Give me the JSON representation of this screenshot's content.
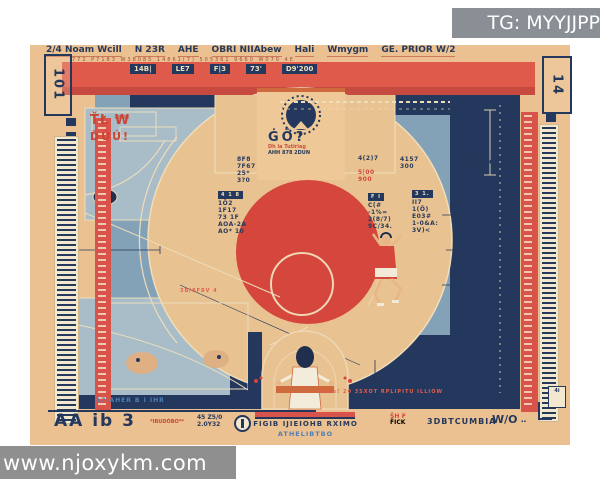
{
  "watermarks": {
    "tg": "TG: MYYJJPP",
    "site": "www.njoxykm.com"
  },
  "colors": {
    "poster_tan": "#ecc191",
    "banner_red": "#e05a4c",
    "navy": "#24375c",
    "court_blue": "#84a2b7",
    "panel_blue": "#a8bdc8",
    "circle_red": "#d5463c",
    "cream": "#f0ddba",
    "accent_orange": "#cf6a3d"
  },
  "header": {
    "tokens": [
      "2/4 Noam Wcill",
      "N 23R",
      "AHE",
      "OBRI NIIAbew",
      "Hali",
      "Wmygm",
      "GE. PRIOR W/2"
    ],
    "sub": "772 P7183 W38085  14861(7)  505361  9660  W070  4E"
  },
  "corners": {
    "left": "101",
    "right": "14",
    "bottom_right_chip": "4i"
  },
  "banner": {
    "chips": [
      "14B|",
      "LE7",
      "F|3",
      "73'",
      "D9'200"
    ]
  },
  "center_top": {
    "caption": "ĠŌ?",
    "sub1": "Dh ia Tutiriag",
    "sub2": "AHH 878 2DUN"
  },
  "stacks": {
    "a": {
      "lines": "8F8\n7F67\n25*\n3?0"
    },
    "b": {
      "chip": "4 1 8",
      "lines": "1Ŏ2\n1F17\n73 1F\nAOA-2A\nAO* 10"
    },
    "c": {
      "lines": "4(2)7",
      "red": "5|00\n900"
    },
    "d": {
      "chip": "F I",
      "lines": "C(#\n-1%=\n2(8/7)\n9C/34."
    },
    "e": {
      "chip": "3 1.",
      "lines": "II7\n1(Ŏ)\nE03#\n1-0&A:\n3V)<"
    },
    "f": {
      "lines": "7009?\nMBI 870"
    },
    "g": {
      "lines": "4157\n300"
    }
  },
  "paint": {
    "mark1": "ŤŁ ₩",
    "mark2": "ĎÚÚ!",
    "mark3": "3B/8F8V  4"
  },
  "notes": {
    "navy_note": "3kwh! 20 3SXOT RPLIPITU ILLIOW",
    "bottom_blue_small": "17 AHER B I IHR",
    "bottom_red_bar": "A9EB3 I IVB"
  },
  "bottom": {
    "logo": "AA ib 3",
    "logo_sub": "*IBUDÒBO**",
    "nums": "45 Z5/0\n2.0Y32",
    "caption1": "FIGIB IJIEIOHB RXIMO",
    "caption2": "ATHELIBTBO",
    "tok_top": "ŠH ₣",
    "tok_bottom": "F̈ICK",
    "tok3": "3DBTCUMBIA",
    "tok4": "W/O",
    "tok5": "‥"
  }
}
